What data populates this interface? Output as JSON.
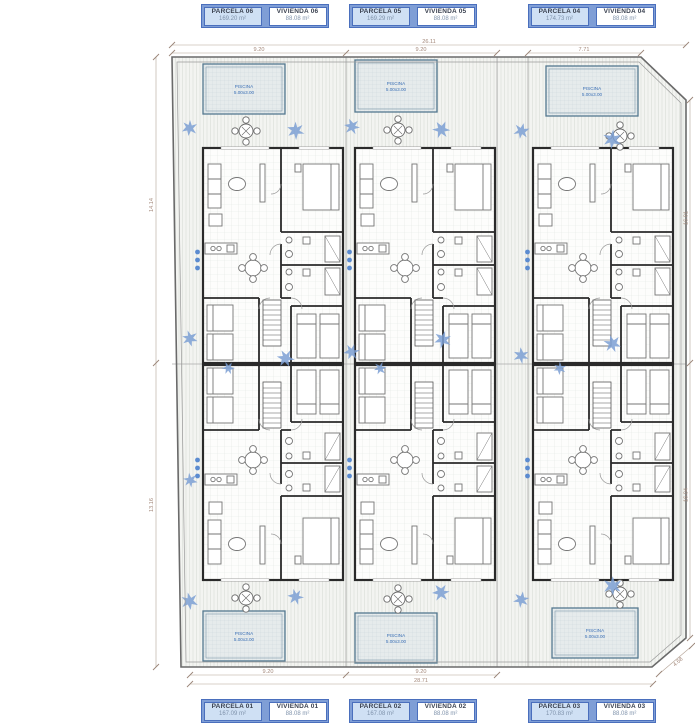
{
  "title": "Residential site plan – six dwellings",
  "labels": {
    "top": [
      {
        "parcela": "PARCELA 06",
        "parcela_area": "169.20 m²",
        "vivienda": "VIVIENDA 06",
        "vivienda_area": "88.08 m²"
      },
      {
        "parcela": "PARCELA 05",
        "parcela_area": "169.29 m²",
        "vivienda": "VIVIENDA 05",
        "vivienda_area": "88.08 m²"
      },
      {
        "parcela": "PARCELA 04",
        "parcela_area": "174.73 m²",
        "vivienda": "VIVIENDA 04",
        "vivienda_area": "88.08 m²"
      }
    ],
    "bottom": [
      {
        "parcela": "PARCELA 01",
        "parcela_area": "167.09 m²",
        "vivienda": "VIVIENDA 01",
        "vivienda_area": "88.08 m²"
      },
      {
        "parcela": "PARCELA 02",
        "parcela_area": "167.08 m²",
        "vivienda": "VIVIENDA 02",
        "vivienda_area": "88.08 m²"
      },
      {
        "parcela": "PARCELA 03",
        "parcela_area": "170.83 m²",
        "vivienda": "VIVIENDA 03",
        "vivienda_area": "88.08 m²"
      }
    ]
  },
  "pool": {
    "line1": "PISCINA",
    "line2": "5.00x3.00"
  },
  "dimensions": {
    "top_total": "26.11",
    "top_seg1": "9.20",
    "top_seg2": "9.20",
    "top_seg3": "7.71",
    "bottom_total": "28.71",
    "bottom_seg1": "9.20",
    "bottom_seg2": "9.20",
    "left_upper": "14.14",
    "left_lower": "13.16",
    "right_upper": "16.01",
    "right_lower": "16.04",
    "diagonal": "4.68"
  },
  "colors": {
    "label_border": "#4a6fbd",
    "label_fill": "#cfe0f4",
    "label_band": "#7f9ed6",
    "pool_edge": "#54788f",
    "plant_blue": "#7b9fd4",
    "accent_dot": "#5b8bd0",
    "wall": "#2a2a2a",
    "dim_text": "#a3887a"
  }
}
